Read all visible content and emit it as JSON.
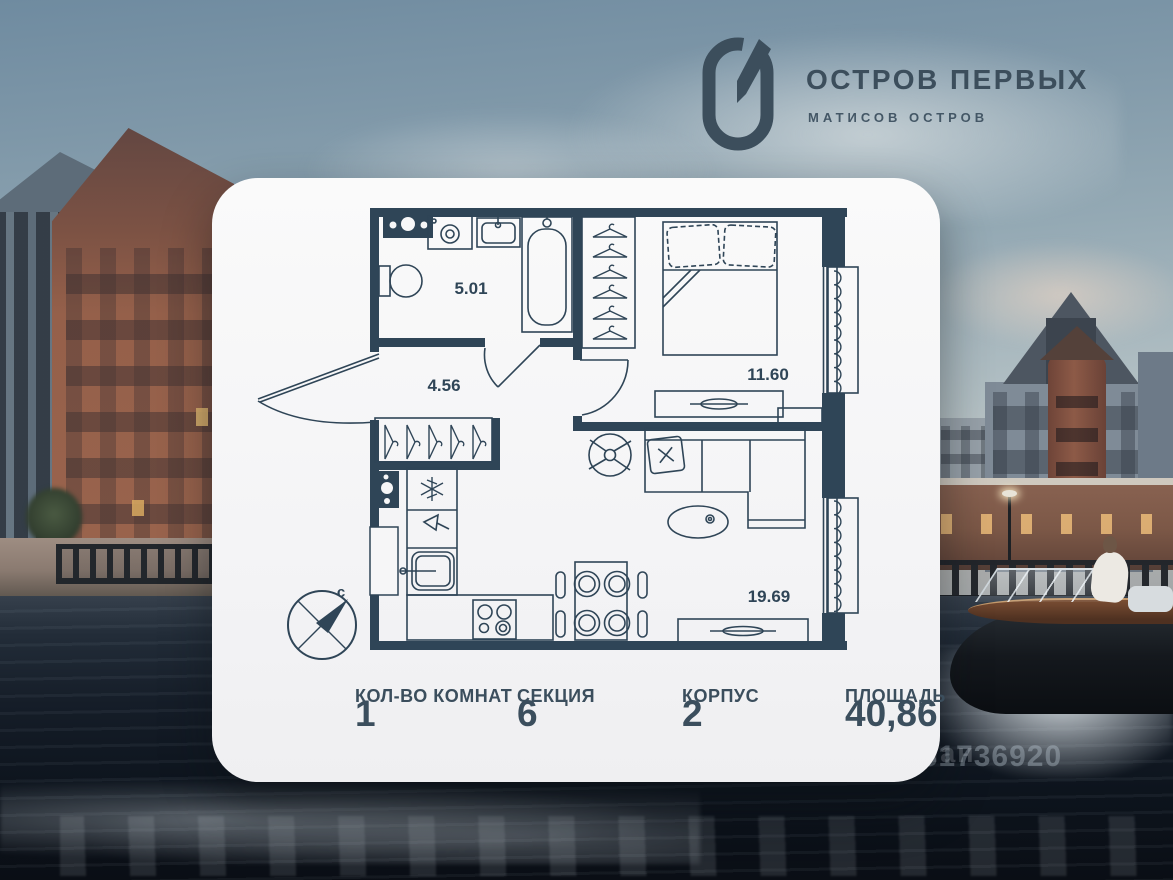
{
  "brand": {
    "title": "ОСТРОВ ПЕРВЫХ",
    "subtitle": "МАТИСОВ ОСТРОВ",
    "logo_icon": "g-monogram",
    "color": "#3c4e5c"
  },
  "floorplan": {
    "compass_label": "с",
    "rooms": [
      {
        "name": "bathroom",
        "area": "5.01"
      },
      {
        "name": "hallway",
        "area": "4.56"
      },
      {
        "name": "bedroom",
        "area": "11.60"
      },
      {
        "name": "living-kitchen",
        "area": "19.69"
      }
    ]
  },
  "stats": {
    "items": [
      {
        "label": "КОЛ-ВО КОМНАТ",
        "value": "1"
      },
      {
        "label": "СЕКЦИЯ",
        "value": "6"
      },
      {
        "label": "КОРПУС",
        "value": "2"
      },
      {
        "label": "ПЛОЩАДЬ",
        "value": "40,86"
      }
    ]
  },
  "watermark": {
    "line1": "циан",
    "line2": "131736920"
  },
  "colors": {
    "plan_walls": "#2f4557",
    "card": "#f6f6f7",
    "water": "#0d141d",
    "brick": "#95604a",
    "accent": "#3b4e5d"
  }
}
